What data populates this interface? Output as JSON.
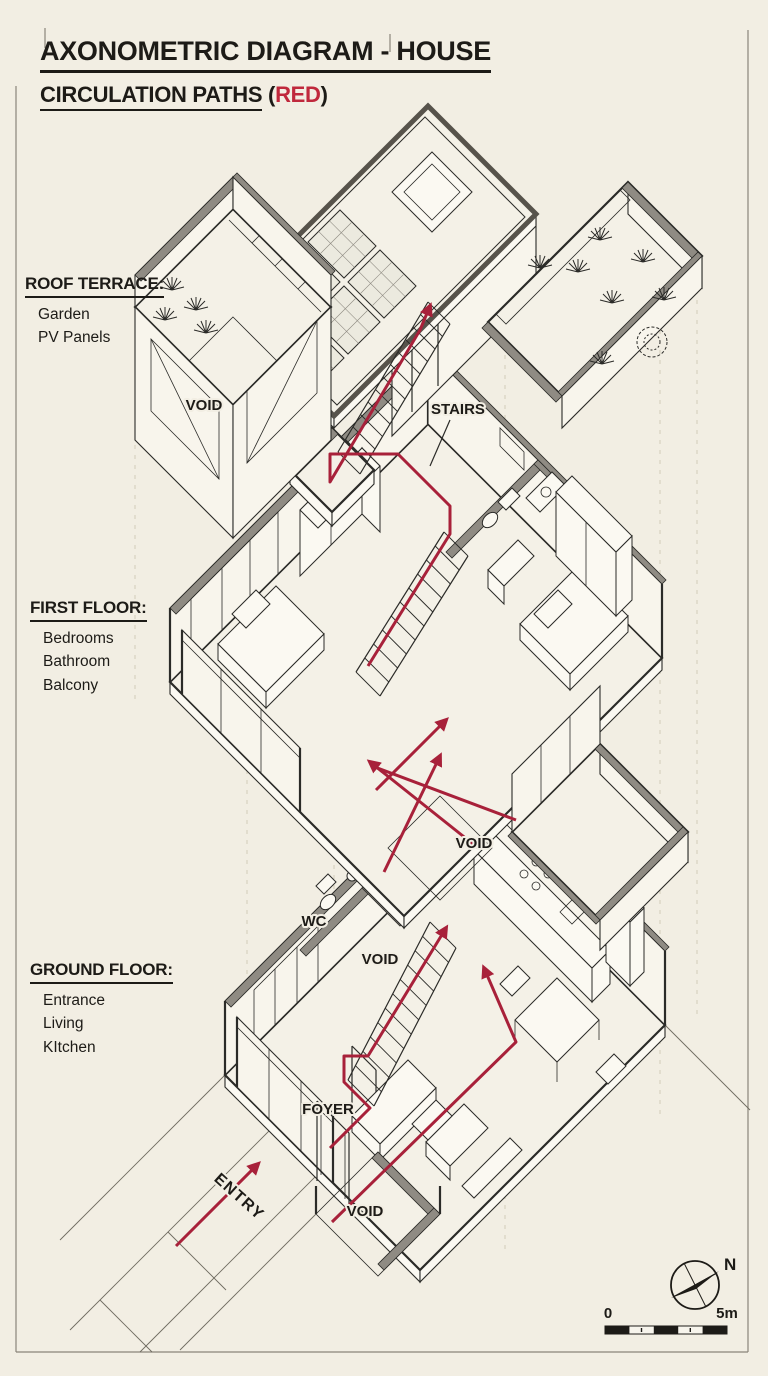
{
  "title": {
    "line1": "AXONOMETRIC DIAGRAM - HOUSE",
    "line2": "CIRCULATION PATHS",
    "paren_open": "(",
    "paren_red": "RED",
    "paren_close": ")"
  },
  "floors": {
    "roof": {
      "heading": "ROOF TERRACE:",
      "items": [
        "Garden",
        "PV Panels"
      ]
    },
    "first": {
      "heading": "FIRST FLOOR:",
      "items": [
        "Bedrooms",
        "Bathroom",
        "Balcony"
      ]
    },
    "ground": {
      "heading": "GROUND FLOOR:",
      "items": [
        "Entrance",
        "Living",
        "KItchen"
      ]
    }
  },
  "annotations": {
    "stairs": "STAIRS",
    "void_roof": "VOID",
    "void_first_floor": "VOID",
    "void_stairwell": "VOID",
    "void_entry": "VOID",
    "wc": "WC",
    "foyer": "FOYER",
    "entry": "ENTRY"
  },
  "compass": {
    "north": "N"
  },
  "scalebar": {
    "zero": "0",
    "five_m": "5m"
  },
  "colors": {
    "paper": "#f2eee3",
    "ink": "#2b2b28",
    "wall_gray": "#8f8b83",
    "circulation_red": "#a8213a",
    "title_red": "#c0283c"
  }
}
